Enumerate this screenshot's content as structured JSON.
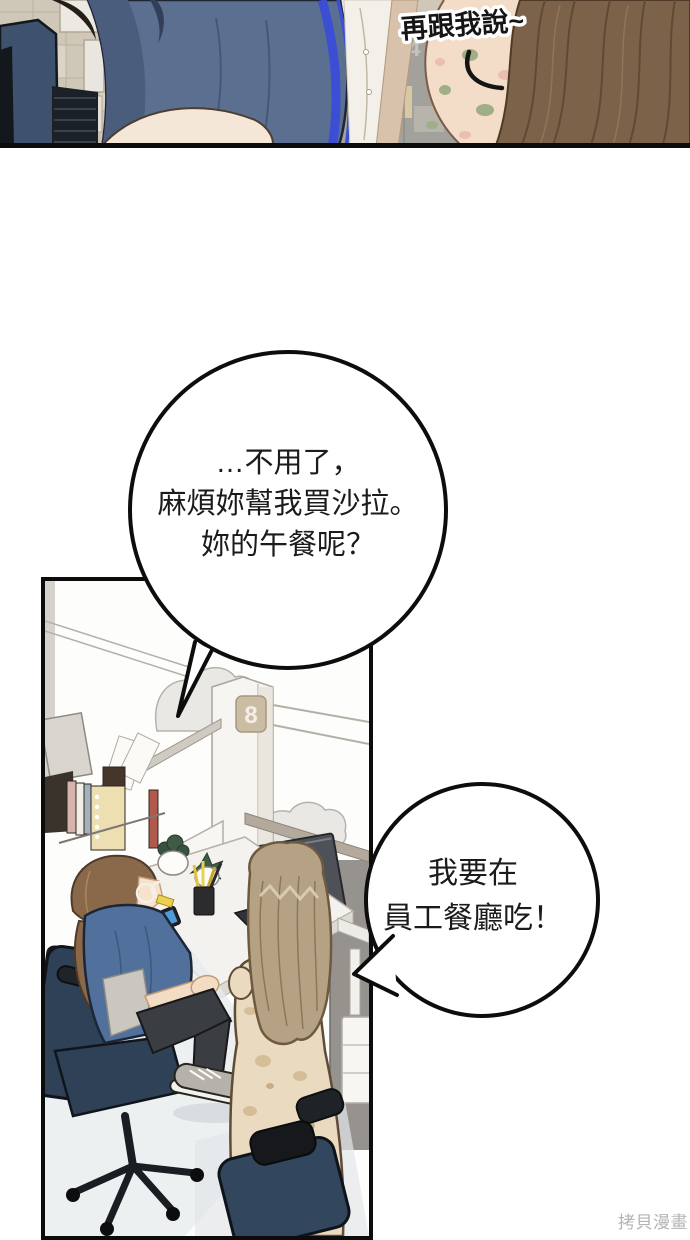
{
  "page": {
    "width": 690,
    "height": 1240,
    "background": "#ffffff",
    "watermark": "拷貝漫畫"
  },
  "panel_top": {
    "speech_text": "再跟我說~",
    "wall_sign_digits": {
      "left": "3",
      "right": "4"
    },
    "colors": {
      "wall": "#cfc7b8",
      "office_chair": "#3e526d",
      "jacket": "#5b6f90",
      "jacket_trim": "#3b4ed4",
      "shirt": "#f3f0e9",
      "inner_lining": "#d8c2ab",
      "floral_blouse": "#f3ddc9",
      "hair": "#7b6248"
    }
  },
  "speech_bubbles": {
    "main": {
      "lines": [
        "…不用了，",
        "麻煩妳幫我買沙拉。",
        "妳的午餐呢？"
      ]
    },
    "reply": {
      "lines": [
        "我要在",
        "員工餐廳吃！"
      ]
    }
  },
  "panel_office": {
    "pillar_sign": "8",
    "colors": {
      "pillar": "#f7f5f1",
      "plaque": "#cbbda3",
      "partition": "#cfcbc3",
      "desk": "#f3f2ef",
      "monitor": "#4e5258",
      "office_chair": "#2e4157",
      "sitting_top": "#52709c",
      "sitting_hair": "#8a684a",
      "standing_hair": "#b5a284",
      "dress": "#eadbc0",
      "right_wall": "#96938e",
      "floor_shadow": "#e7ebed"
    }
  }
}
